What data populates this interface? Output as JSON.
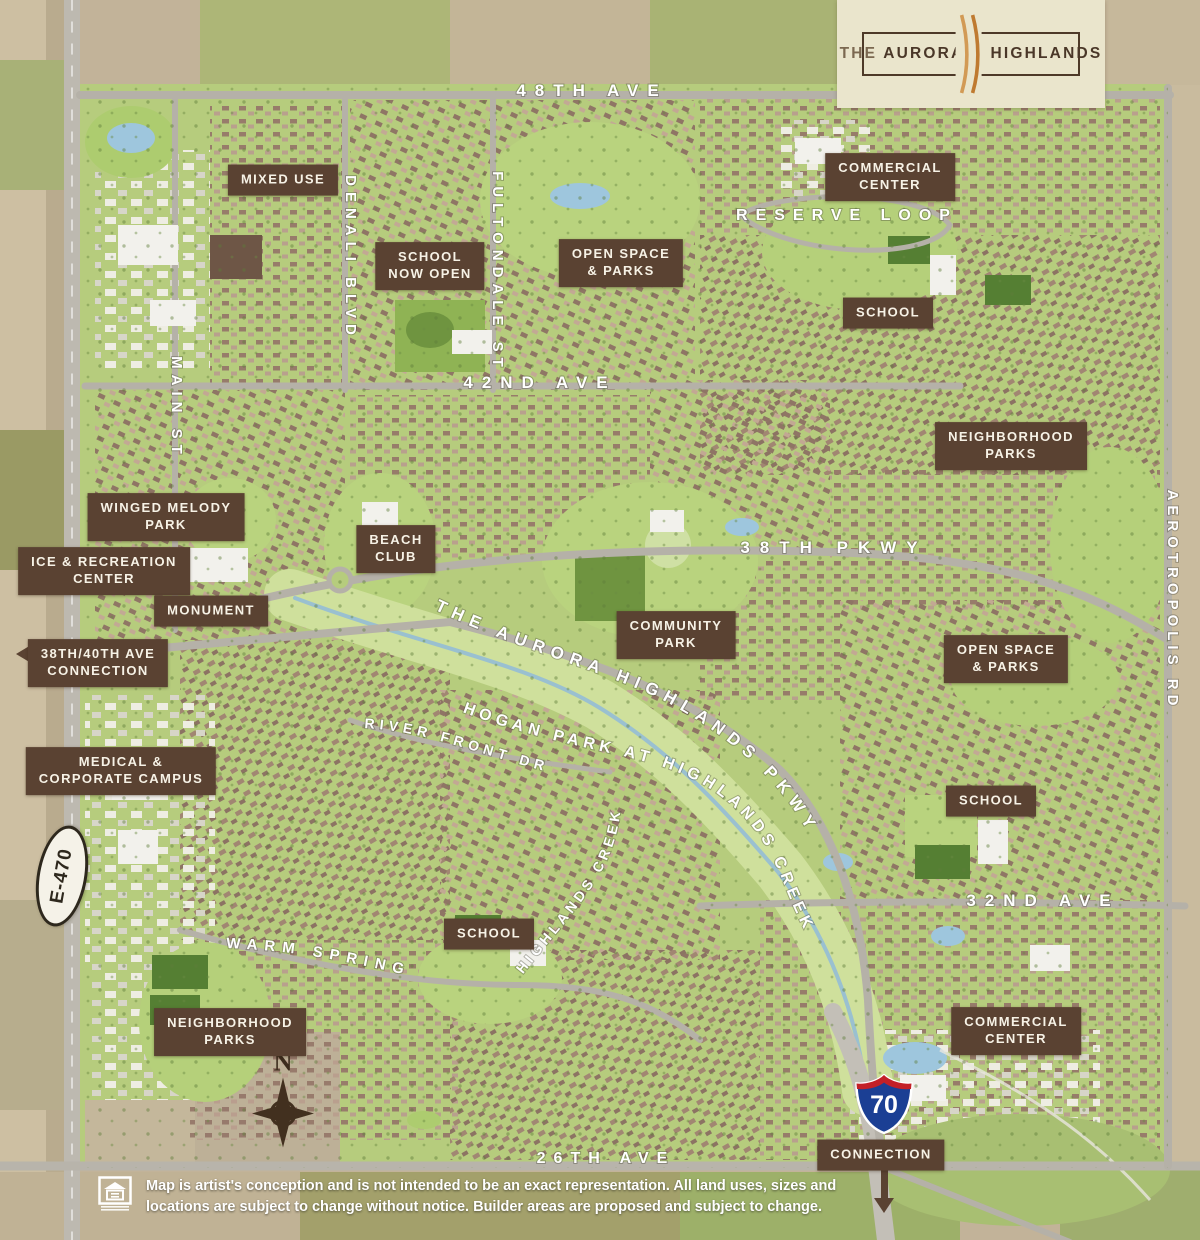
{
  "logo": {
    "the": "THE",
    "name1": "AURORA",
    "name2": "HIGHLANDS",
    "accent_color": "#c77f35",
    "panel_color": "#eae5cc",
    "text_color": "#4a3728"
  },
  "badges": {
    "e470": {
      "label": "E-470"
    },
    "i70": {
      "number": "70"
    }
  },
  "compass": {
    "north_label": "N"
  },
  "disclaimer": {
    "line1": "Map is artist's conception and is not intended to be an exact representation. All land uses, sizes and",
    "line2": "locations are subject to change without notice. Builder areas are proposed and subject to change."
  },
  "colors": {
    "label_background": "#5a4232",
    "label_text": "#f7f2e6",
    "road_label_text": "#ffffff",
    "farmland": "#c2b399",
    "development_green": "#b6cc7d",
    "water": "#9ec6dd"
  },
  "map": {
    "place_labels": [
      {
        "id": "mixed-use",
        "lines": [
          "MIXED USE"
        ],
        "x": 283,
        "y": 180
      },
      {
        "id": "school-now-open",
        "lines": [
          "SCHOOL",
          "NOW OPEN"
        ],
        "x": 430,
        "y": 266
      },
      {
        "id": "open-space-parks-north",
        "lines": [
          "OPEN SPACE",
          "& PARKS"
        ],
        "x": 621,
        "y": 263
      },
      {
        "id": "commercial-center-north",
        "lines": [
          "COMMERCIAL",
          "CENTER"
        ],
        "x": 890,
        "y": 177
      },
      {
        "id": "school-northeast",
        "lines": [
          "SCHOOL"
        ],
        "x": 888,
        "y": 313
      },
      {
        "id": "neighborhood-parks-east",
        "lines": [
          "NEIGHBORHOOD",
          "PARKS"
        ],
        "x": 1011,
        "y": 446
      },
      {
        "id": "winged-melody-park",
        "lines": [
          "WINGED MELODY",
          "PARK"
        ],
        "x": 166,
        "y": 517
      },
      {
        "id": "ice-recreation-center",
        "lines": [
          "ICE & RECREATION",
          "CENTER"
        ],
        "x": 104,
        "y": 571
      },
      {
        "id": "monument",
        "lines": [
          "MONUMENT"
        ],
        "x": 211,
        "y": 611
      },
      {
        "id": "38th-40th-ave-connection",
        "lines": [
          "38TH/40TH AVE",
          "CONNECTION"
        ],
        "x": 98,
        "y": 663
      },
      {
        "id": "beach-club",
        "lines": [
          "BEACH",
          "CLUB"
        ],
        "x": 396,
        "y": 549
      },
      {
        "id": "community-park",
        "lines": [
          "COMMUNITY",
          "PARK"
        ],
        "x": 676,
        "y": 635
      },
      {
        "id": "open-space-parks-southeast",
        "lines": [
          "OPEN SPACE",
          "& PARKS"
        ],
        "x": 1006,
        "y": 659
      },
      {
        "id": "medical-corporate-campus",
        "lines": [
          "MEDICAL &",
          "CORPORATE CAMPUS"
        ],
        "x": 121,
        "y": 771
      },
      {
        "id": "school-east",
        "lines": [
          "SCHOOL"
        ],
        "x": 991,
        "y": 801
      },
      {
        "id": "school-south",
        "lines": [
          "SCHOOL"
        ],
        "x": 489,
        "y": 934
      },
      {
        "id": "neighborhood-parks-south",
        "lines": [
          "NEIGHBORHOOD",
          "PARKS"
        ],
        "x": 230,
        "y": 1032
      },
      {
        "id": "commercial-center-south",
        "lines": [
          "COMMERCIAL",
          "CENTER"
        ],
        "x": 1016,
        "y": 1031
      },
      {
        "id": "connection",
        "lines": [
          "CONNECTION"
        ],
        "x": 881,
        "y": 1155
      }
    ],
    "road_labels": [
      {
        "id": "48th-ave",
        "text": "48TH AVE",
        "x": 592,
        "y": 96,
        "fs": 17,
        "ls": 9
      },
      {
        "id": "reserve-loop",
        "text": "RESERVE LOOP",
        "x": 847,
        "y": 220,
        "fs": 16,
        "ls": 8
      },
      {
        "id": "denali-blvd",
        "text": "DENALI BLVD",
        "x": 346,
        "y": 258,
        "rot": 90,
        "fs": 15,
        "ls": 6
      },
      {
        "id": "fultondale-st",
        "text": "FULTONDALE ST",
        "x": 493,
        "y": 272,
        "rot": 90,
        "fs": 15,
        "ls": 6
      },
      {
        "id": "main-st",
        "text": "MAIN ST",
        "x": 172,
        "y": 408,
        "rot": 90,
        "fs": 15,
        "ls": 6
      },
      {
        "id": "42nd-ave",
        "text": "42ND AVE",
        "x": 540,
        "y": 388,
        "fs": 17,
        "ls": 9
      },
      {
        "id": "38th-pkwy",
        "text": "38TH PKWY",
        "x": 834,
        "y": 553,
        "fs": 17,
        "ls": 10
      },
      {
        "id": "aurora-highlands-pkwy",
        "text": "THE AURORA HIGHLANDS PKWY",
        "pathId": "path-ahp",
        "fs": 17,
        "ls": 7
      },
      {
        "id": "hogan-park-at-highlands-creek",
        "text": "HOGAN PARK AT HIGHLANDS CREEK",
        "pathId": "path-hogan",
        "fs": 16,
        "ls": 5
      },
      {
        "id": "highlands-creek",
        "text": "HIGHLANDS CREEK",
        "pathId": "path-creek-label",
        "fs": 14,
        "ls": 4
      },
      {
        "id": "river-front-dr",
        "text": "RIVER FRONT DR",
        "pathId": "path-river",
        "fs": 14,
        "ls": 5
      },
      {
        "id": "warm-springs",
        "text": "WARM SPRINGS",
        "pathId": "path-warm",
        "fs": 15,
        "ls": 7
      },
      {
        "id": "32nd-ave",
        "text": "32ND AVE",
        "x": 1043,
        "y": 906,
        "fs": 17,
        "ls": 9
      },
      {
        "id": "aerotropolis-rd",
        "text": "AEROTROPOLIS RD",
        "x": 1168,
        "y": 600,
        "rot": 90,
        "fs": 15,
        "ls": 5
      },
      {
        "id": "26th-ave",
        "text": "26TH AVE",
        "x": 606,
        "y": 1163,
        "fs": 16,
        "ls": 8
      }
    ]
  }
}
